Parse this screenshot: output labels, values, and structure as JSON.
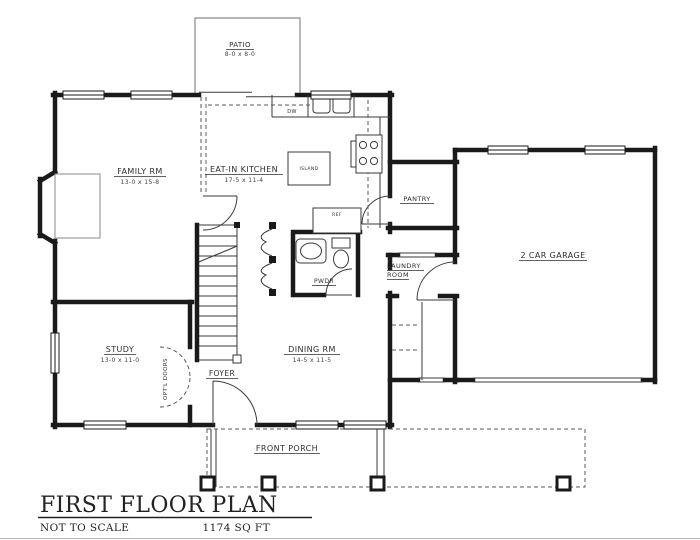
{
  "drawing": {
    "title": "FIRST FLOOR PLAN",
    "scale_note": "NOT TO SCALE",
    "area": "1174 SQ FT"
  },
  "rooms": {
    "patio": {
      "name": "PATIO",
      "dims": "8-0 x 8-0"
    },
    "family": {
      "name": "FAMILY RM",
      "dims": "13-0 x 15-8"
    },
    "kitchen": {
      "name": "EAT-IN KITCHEN",
      "dims": "17-5 x 11-4"
    },
    "island": {
      "name": "ISLAND"
    },
    "pantry": {
      "name": "PANTRY"
    },
    "garage": {
      "name": "2 CAR GARAGE"
    },
    "laundry": {
      "line1": "LAUNDRY",
      "line2": "ROOM"
    },
    "powder": {
      "name": "PWDR"
    },
    "study": {
      "name": "STUDY",
      "dims": "13-0 x 11-0"
    },
    "foyer": {
      "name": "FOYER"
    },
    "dining": {
      "name": "DINING RM",
      "dims": "14-5 x 11-5"
    },
    "porch": {
      "name": "FRONT PORCH"
    }
  },
  "fixtures": {
    "dishwasher": "DW",
    "refrigerator": "REF",
    "optional_doors": "OPT'L DOORS"
  },
  "colors": {
    "wall": "#1a1a1a",
    "thin_line": "#3a3a3a",
    "light_line": "#777777"
  }
}
